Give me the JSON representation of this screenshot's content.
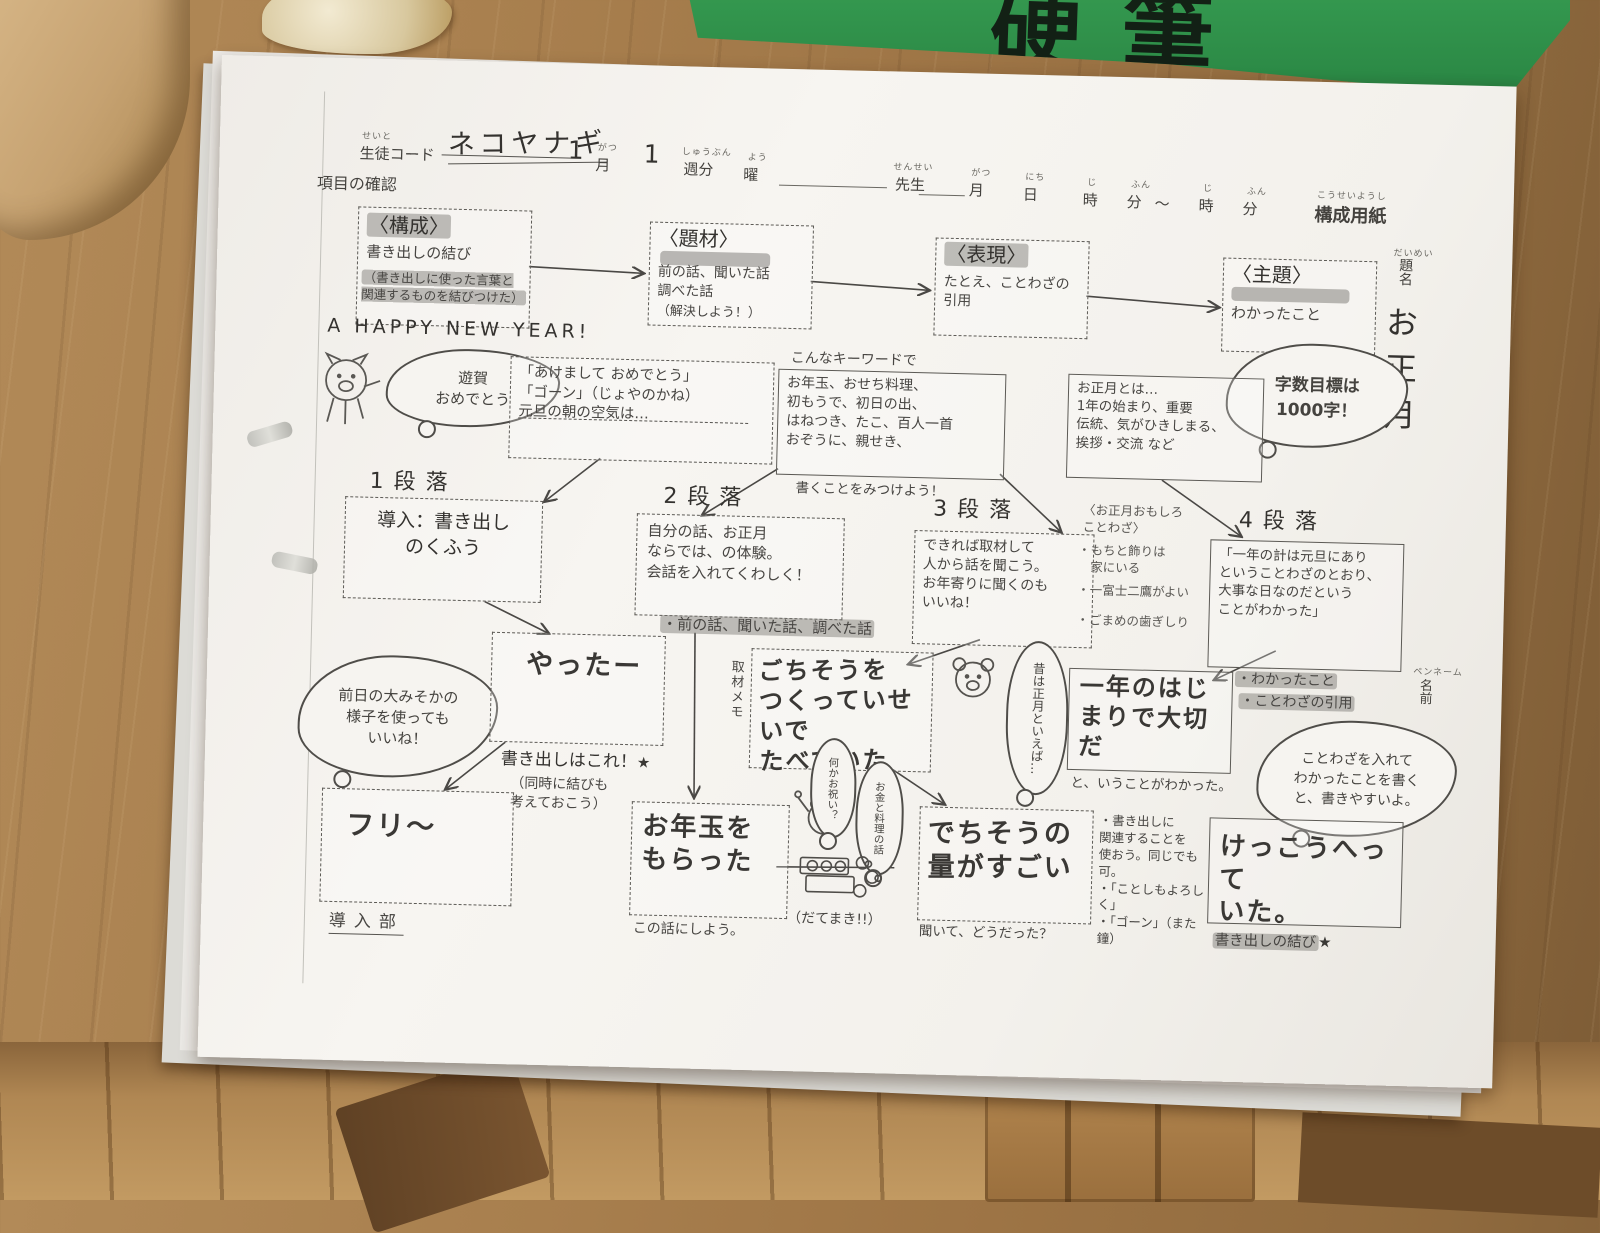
{
  "scene": {
    "green_folder_text": "硬筆"
  },
  "header": {
    "student_code_furigana": "せいと",
    "student_code_label": "生徒コード",
    "student_code_value": "ネコヤナギ",
    "month_stroke": "1",
    "month_label": "月",
    "month_furigana": "がつ",
    "week_stroke": "1",
    "week_label": "週分",
    "week_furigana": "しゅうぶん",
    "day_label": "曜",
    "day_furigana": "よう",
    "teacher_label": "先生",
    "teacher_furigana": "せんせい",
    "date_month": "月",
    "date_month_furigana": "がつ",
    "date_day": "日",
    "date_day_furigana": "にち",
    "date_hour": "時",
    "date_hour_furigana": "じ",
    "date_min": "分",
    "date_min_furigana": "ふん",
    "tilde": "〜",
    "date_hour2": "時",
    "date_hour2_furigana": "じ",
    "date_min2": "分",
    "date_min2_furigana": "ふん",
    "sheet_title": "構成用紙",
    "sheet_title_furigana": "こうせいようし",
    "section_label": "項目の確認"
  },
  "top_boxes": [
    {
      "title": "〈構成〉",
      "line1": "書き出しの結び",
      "line2": "（書き出しに使った言葉と\n関連するものを結びつけた）"
    },
    {
      "title": "〈題材〉",
      "line1": "前の話、聞いた話\n調べた話",
      "line2": "（解決しよう！）"
    },
    {
      "title": "〈表現〉",
      "line1": "たとえ、ことわざの\n引用",
      "line2": ""
    },
    {
      "title": "〈主題〉",
      "line1": "わかったこと",
      "line2": ""
    }
  ],
  "title_column": {
    "furigana": "だいめい",
    "label": "題名",
    "value": "お正月",
    "penname_furigana": "ペンネーム",
    "penname": "名前"
  },
  "goal_cloud": "字数目標は\n1000字！",
  "happy_new_year": "A HAPPY NEW YEAR!",
  "pig_bubble": "遊賀\nおめでとう",
  "greeting_box": "「あけまして おめでとう」\n「ゴーン」（じょやのかね）\n元旦の朝の空気は…",
  "keyword_note": {
    "title": "こんなキーワードで",
    "items": "お年玉、おせち料理、\n初もうで、初日の出、\nはねつき、たこ、百人一首\nおぞうに、親せき、",
    "footer": "書くことをみつけよう！"
  },
  "oshogatsu_box": "お正月とは…\n1年の始まり、重要\n伝統、気がひきしまる、\n挨拶・交流 など",
  "paragraphs": [
    {
      "label": "1段落",
      "body": "導入：書き出し\nのくふう"
    },
    {
      "label": "2段落",
      "body": "自分の話、お正月\nならでは、の体験。\n会話を入れてくわしく！"
    },
    {
      "label": "3段落",
      "body": "できれば取材して\n人から話を聞こう。\nお年寄りに聞くのも\nいいね！"
    },
    {
      "label": "4段落",
      "body": "「一年の計は元旦にあり\nということわざのとおり、\n大事な日なのだという\nことがわかった」"
    }
  ],
  "kotowaza_note": {
    "title": "〈お正月おもしろ\nことわざ〉",
    "item1": "・もちと飾りは\n　家にいる",
    "item2": "・一富士二鷹がよい",
    "item3": "・ごまめの歯ぎしり"
  },
  "checked_points": {
    "line1": "・わかったこと",
    "line2": "・ことわざの引用"
  },
  "advice_cloud": "ことわざを入れて\nわかったことを書く\nと、書きやすいよ。",
  "left_cloud": "前日の大みそかの\n様子を使っても\nいいね！",
  "yatta_box": "やったー",
  "yatta_note1": "書き出しはこれ！",
  "yatta_star": "★",
  "yatta_note2": "（同時に結びも\n考えておこう）",
  "sources_line": "・前の話、聞いた話、調べた話",
  "memo_label": "取材メモ",
  "gochisou_box": "ごちそうを\nつくっていせいで\nたべていた",
  "mukashi_bubble": "昔は正月といえば…",
  "ichinen_box": "一年のはじ\nまりで大切\nだ",
  "ichinen_note": "と、いうことがわかった。",
  "furi_box": "フリ〜",
  "dounyubu": "導入部",
  "otoshidama_box": "お年玉を\nもらった",
  "kono_hanashi": "この話にしよう。",
  "frog_bubble1": "何かお祝い？",
  "frog_bubble2": "お金と料理の話",
  "datemaki": "（だてまき!!）",
  "ryou_box": "でちそうの\n量がすごい",
  "kiite": "聞いて、どうだった？",
  "notes_right": "・書き出しに\n関連することを\n使おう。同じでも可。\n・「ことしもよろしく」\n・「ゴーン」（また鐘）",
  "kekkou_box": "けっこうへって\nいた。",
  "kakidashi_musubi": "書き出しの結び",
  "kakidashi_star": "★"
}
